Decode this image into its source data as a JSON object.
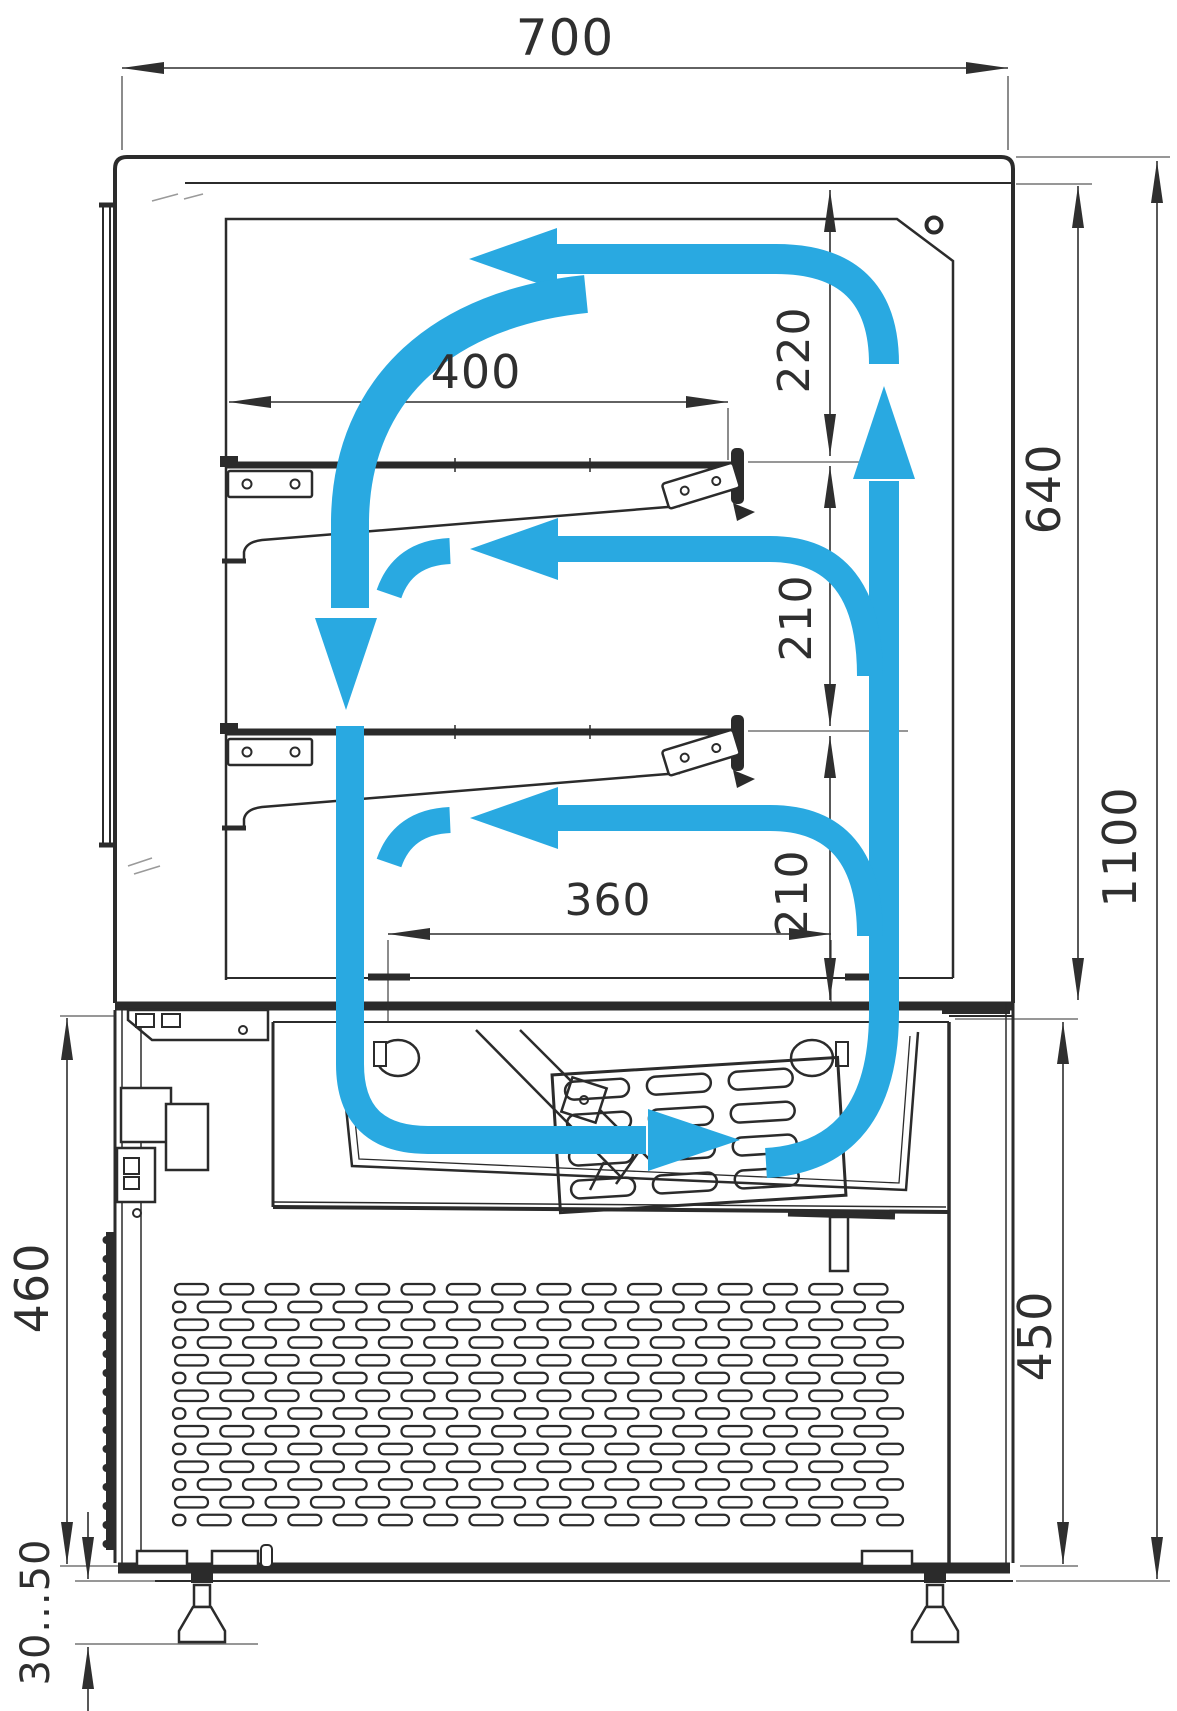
{
  "diagram": {
    "type": "technical-drawing",
    "subject": "Refrigerated pastry display case - side cross-section with air circulation",
    "units": "mm",
    "colors": {
      "line": "#2b2b2b",
      "airflow": "#29a9e1",
      "background": "#ffffff"
    },
    "dimensions": {
      "overall_width": "700",
      "overall_height": "1100",
      "inner_height": "640",
      "top_clearance": "220",
      "shelf_gap_upper": "210",
      "shelf_gap_lower": "210",
      "shelf_depth": "400",
      "air_outlet_width": "360",
      "base_height_left": "460",
      "base_height_right": "450",
      "adjustable_feet_range": "30...50"
    }
  }
}
